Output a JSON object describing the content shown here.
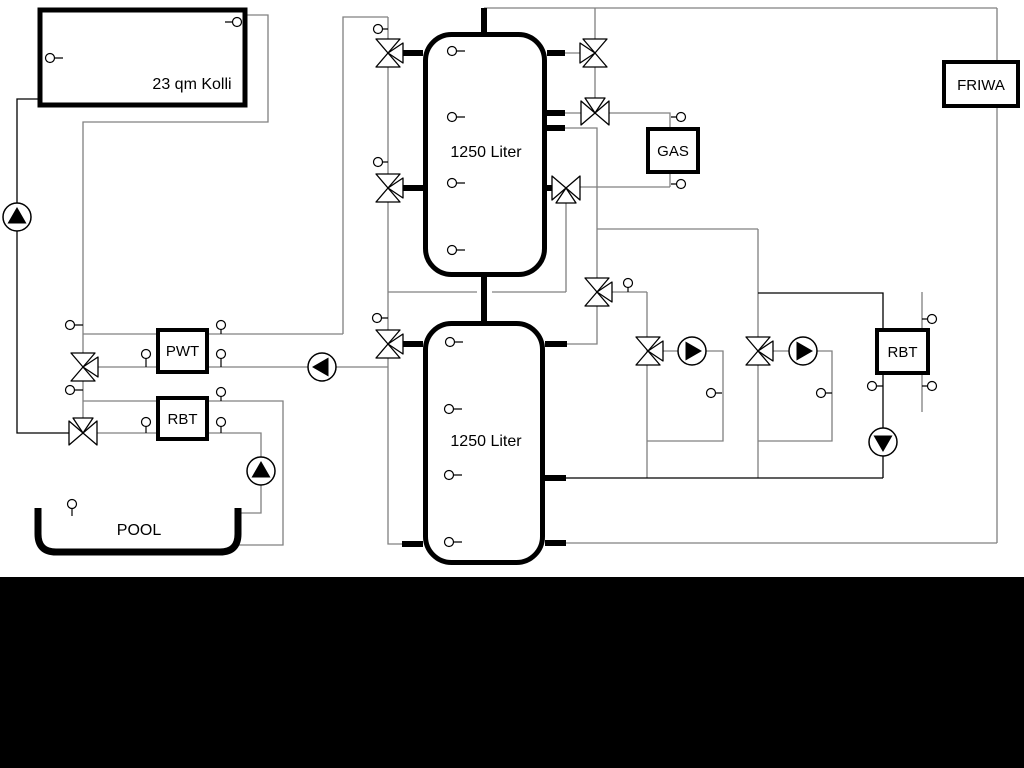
{
  "labels": {
    "collector": "23 qm Kolli",
    "tank1": "1250 Liter",
    "tank2": "1250 Liter",
    "pwt": "PWT",
    "rbt_pool": "RBT",
    "gas": "GAS",
    "friwa": "FRIWA",
    "rbt_heating": "RBT",
    "pool": "POOL"
  },
  "colors": {
    "pipe_gray": "#808080",
    "pipe_black": "#000000",
    "background": "#ffffff",
    "footer_bar": "#000000"
  }
}
